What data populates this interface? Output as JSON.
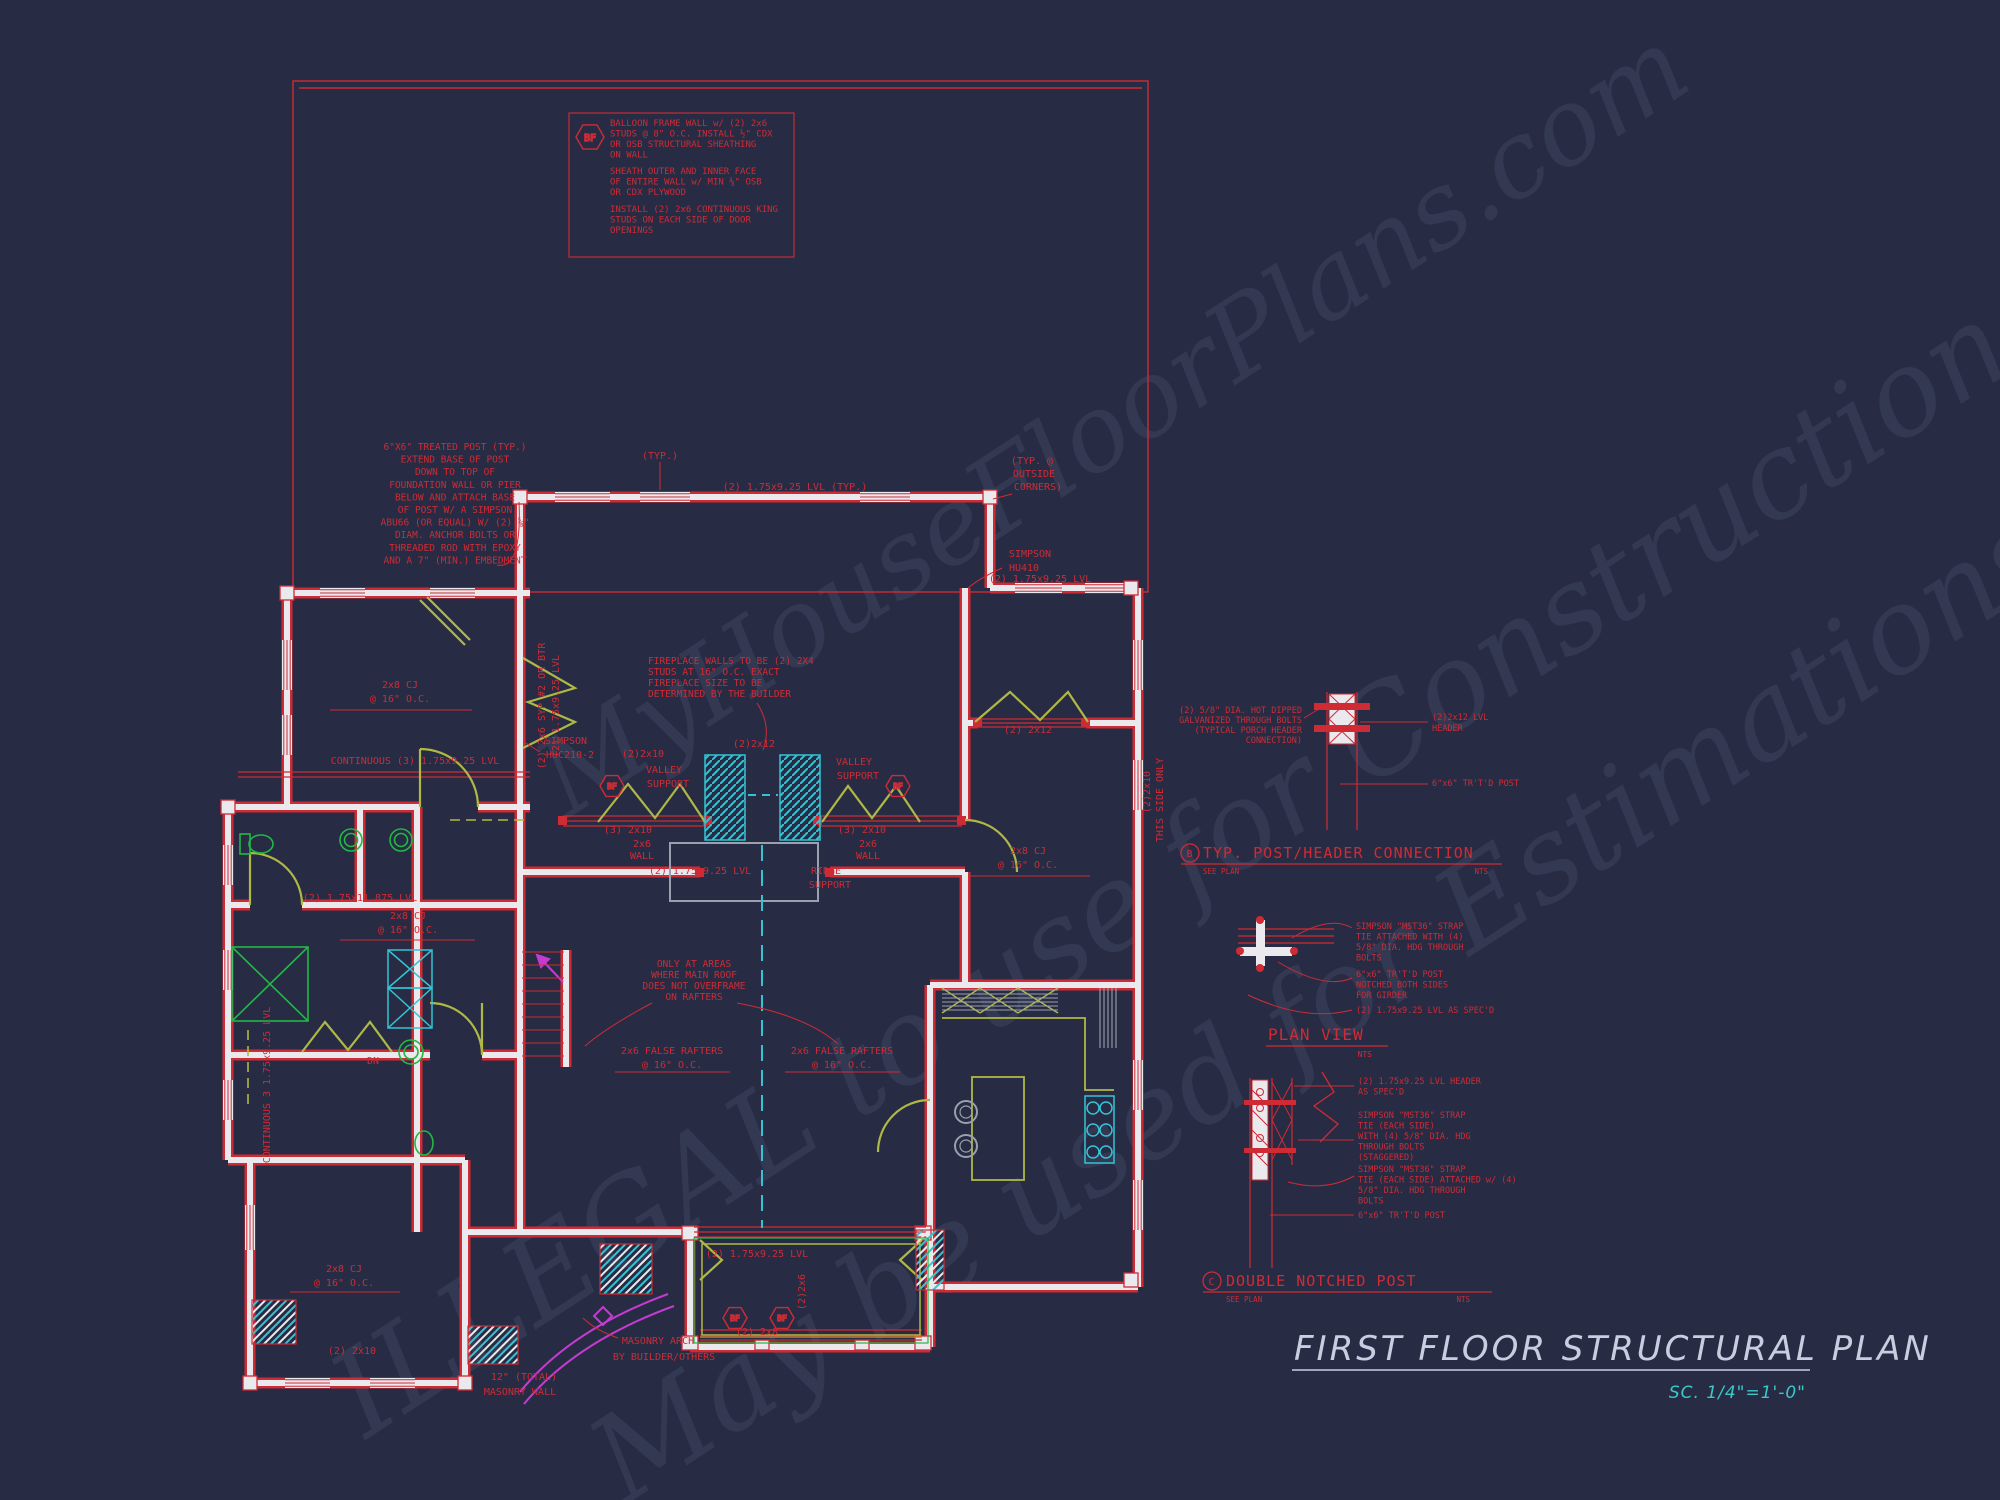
{
  "colors": {
    "background": "#272c44",
    "cad_red": "#cf2b35",
    "olive_header": "#b0b845",
    "cyan": "#35c3d4",
    "green_fixture": "#21b944",
    "magenta": "#c43bd0",
    "wall_white": "#e9e9ee",
    "gray_line": "#9aa0ad",
    "title_light": "#c9cde0",
    "scale_cyan": "#38caca",
    "orange": "#d08030"
  },
  "watermarks": [
    {
      "text": "MyHouseFloorPlans.com"
    },
    {
      "text": "ILLEGAL to use for Construction"
    },
    {
      "text": "May be used for Estimations"
    }
  ],
  "markers": {
    "bf": "BF"
  },
  "notes": [
    {
      "id": "bf1",
      "x": 610,
      "y": 126,
      "lh": 10.5,
      "size": 9,
      "anchor": "start",
      "lines": [
        "BALLOON FRAME WALL w/ (2) 2x6",
        "STUDS @ 8\" O.C. INSTALL ½\" CDX",
        "OR OSB STRUCTURAL SHEATHING",
        "ON WALL"
      ]
    },
    {
      "id": "bf2",
      "x": 610,
      "y": 174,
      "lh": 10.5,
      "size": 9,
      "anchor": "start",
      "lines": [
        "SHEATH OUTER AND INNER FACE",
        "OF ENTIRE WALL w/ MIN ⅜\" OSB",
        "OR CDX PLYWOOD"
      ]
    },
    {
      "id": "bf3",
      "x": 610,
      "y": 212,
      "lh": 10.5,
      "size": 9,
      "anchor": "start",
      "lines": [
        "INSTALL (2) 2x6 CONTINUOUS KING",
        "STUDS ON EACH SIDE OF DOOR",
        "OPENINGS"
      ]
    },
    {
      "id": "treated_post",
      "x": 455,
      "y": 450,
      "lh": 12.6,
      "size": 9.5,
      "anchor": "middle",
      "lines": [
        "6\"X6\" TREATED POST (TYP.)",
        "EXTEND BASE OF POST",
        "DOWN TO TOP OF",
        "FOUNDATION WALL OR PIER",
        "BELOW AND ATTACH BASE",
        "OF POST W/ A SIMPSON",
        "ABU66 (OR EQUAL) W/ (2) ⅝\"",
        "DIAM. ANCHOR BOLTS OR",
        "THREADED ROD WITH EPOXY",
        "AND A 7\" (MIN.) EMBEDMENT"
      ]
    },
    {
      "id": "fireplace",
      "x": 648,
      "y": 664,
      "lh": 11,
      "size": 9.5,
      "anchor": "start",
      "lines": [
        "FIREPLACE WALLS TO BE (2) 2X4",
        "STUDS AT 16\" O.C. EXACT",
        "FIREPLACE SIZE TO BE",
        "DETERMINED BY THE BUILDER"
      ]
    },
    {
      "id": "overframe",
      "x": 694,
      "y": 967,
      "lh": 11,
      "size": 9.5,
      "anchor": "middle",
      "lines": [
        "ONLY AT AREAS",
        "WHERE MAIN ROOF",
        "DOES NOT OVERFRAME",
        "ON RAFTERS"
      ]
    },
    {
      "id": "detail_b_left",
      "x": 1302,
      "y": 713,
      "lh": 10,
      "size": 8.5,
      "anchor": "end",
      "lines": [
        "(2) 5/8\" DIA. HOT DIPPED",
        "GALVANIZED THROUGH BOLTS",
        "(TYPICAL PORCH HEADER",
        "CONNECTION)"
      ]
    },
    {
      "id": "detail_b_right1",
      "x": 1432,
      "y": 720,
      "lh": 11,
      "size": 8.5,
      "anchor": "start",
      "lines": [
        "(2)2x12 LVL",
        "HEADER"
      ]
    },
    {
      "id": "detail_b_right2",
      "x": 1432,
      "y": 786,
      "lh": 11,
      "size": 8.5,
      "anchor": "start",
      "lines": [
        "6\"x6\" TR'T'D POST"
      ]
    },
    {
      "id": "plan_view_n1",
      "x": 1356,
      "y": 929,
      "lh": 10.5,
      "size": 8.5,
      "anchor": "start",
      "lines": [
        "SIMPSON \"MST36\" STRAP",
        "TIE ATTACHED WITH (4)",
        "5/8\" DIA. HDG THROUGH",
        "BOLTS"
      ]
    },
    {
      "id": "plan_view_n2",
      "x": 1356,
      "y": 977,
      "lh": 10.5,
      "size": 8.5,
      "anchor": "start",
      "lines": [
        "6\"x6\" TR'T'D POST",
        "NOTCHED BOTH SIDES",
        "FOR GIRDER"
      ]
    },
    {
      "id": "plan_view_n3",
      "x": 1356,
      "y": 1013,
      "lh": 10.5,
      "size": 8.5,
      "anchor": "start",
      "lines": [
        "(2) 1.75x9.25 LVL AS SPEC'D"
      ]
    },
    {
      "id": "detail_c_n1",
      "x": 1358,
      "y": 1084,
      "lh": 10.5,
      "size": 8.5,
      "anchor": "start",
      "lines": [
        "(2) 1.75x9.25 LVL HEADER",
        "AS SPEC'D"
      ]
    },
    {
      "id": "detail_c_n2",
      "x": 1358,
      "y": 1118,
      "lh": 10.5,
      "size": 8.5,
      "anchor": "start",
      "lines": [
        "SIMPSON \"MST36\" STRAP",
        "TIE (EACH SIDE)",
        "WITH (4) 5/8\" DIA. HDG",
        "THROUGH BOLTS",
        "(STAGGERED)"
      ]
    },
    {
      "id": "detail_c_n3",
      "x": 1358,
      "y": 1172,
      "lh": 10.5,
      "size": 8.5,
      "anchor": "start",
      "lines": [
        "SIMPSON \"MST36\" STRAP",
        "TIE (EACH SIDE) ATTACHED w/ (4)",
        "5/8\" DIA. HDG THROUGH",
        "BOLTS"
      ]
    },
    {
      "id": "detail_c_n4",
      "x": 1358,
      "y": 1218,
      "lh": 10.5,
      "size": 8.5,
      "anchor": "start",
      "lines": [
        "6\"x6\" TR'T'D POST"
      ]
    }
  ],
  "plan": {
    "labels": [
      {
        "t": "(TYP.)",
        "x": 660,
        "y": 459
      },
      {
        "t": "(2) 1.75x9.25 LVL (TYP.)",
        "x": 795,
        "y": 490
      },
      {
        "t": "(TYP. @",
        "x": 1032,
        "y": 464
      },
      {
        "t": "OUTSIDE",
        "x": 1034,
        "y": 477
      },
      {
        "t": "CORNERS)",
        "x": 1038,
        "y": 490
      },
      {
        "t": "SIMPSON",
        "x": 1030,
        "y": 557
      },
      {
        "t": "HU410",
        "x": 1024,
        "y": 571
      },
      {
        "t": "(2) 1.75x9.25 LVL",
        "x": 1040,
        "y": 582
      },
      {
        "t": "SIMPSON",
        "x": 566,
        "y": 744
      },
      {
        "t": "HUC210-2",
        "x": 570,
        "y": 758
      },
      {
        "t": "2x8 CJ",
        "x": 400,
        "y": 688
      },
      {
        "t": "@ 16\" O.C.",
        "x": 400,
        "y": 702
      },
      {
        "t": "CONTINUOUS (3) 1.75x9.25 LVL",
        "x": 415,
        "y": 764
      },
      {
        "t": "(2) 1.75x11.875 LVL",
        "x": 360,
        "y": 901
      },
      {
        "t": "2x8 CJ",
        "x": 408,
        "y": 919
      },
      {
        "t": "@ 16\" O.C.",
        "x": 408,
        "y": 933
      },
      {
        "t": "(2)2x10",
        "x": 643,
        "y": 757
      },
      {
        "t": "VALLEY",
        "x": 664,
        "y": 773
      },
      {
        "t": "SUPPORT",
        "x": 668,
        "y": 787
      },
      {
        "t": "VALLEY",
        "x": 854,
        "y": 765
      },
      {
        "t": "SUPPORT",
        "x": 858,
        "y": 779
      },
      {
        "t": "(3) 2x10",
        "x": 628,
        "y": 833
      },
      {
        "t": "(3) 2x10",
        "x": 862,
        "y": 833
      },
      {
        "t": "2x6",
        "x": 642,
        "y": 847
      },
      {
        "t": "WALL",
        "x": 642,
        "y": 859
      },
      {
        "t": "2x6",
        "x": 868,
        "y": 847
      },
      {
        "t": "WALL",
        "x": 868,
        "y": 859
      },
      {
        "t": "(2) 1.75x9.25 LVL",
        "x": 700,
        "y": 874
      },
      {
        "t": "RIDGE",
        "x": 826,
        "y": 874
      },
      {
        "t": "SUPPORT",
        "x": 830,
        "y": 888
      },
      {
        "t": "(2)2x12",
        "x": 754,
        "y": 747
      },
      {
        "t": "2x8 CJ",
        "x": 1028,
        "y": 854
      },
      {
        "t": "@ 16\" O.C.",
        "x": 1028,
        "y": 868
      },
      {
        "t": "(2) 2x12",
        "x": 1028,
        "y": 733
      },
      {
        "t": "(2)2x10",
        "x": 1150,
        "y": 792,
        "r": -90
      },
      {
        "t": "THIS SIDE ONLY",
        "x": 1163,
        "y": 800,
        "r": -90
      },
      {
        "t": "2x6 FALSE RAFTERS",
        "x": 672,
        "y": 1054
      },
      {
        "t": "@ 16\" O.C.",
        "x": 672,
        "y": 1068
      },
      {
        "t": "2x6 FALSE RAFTERS",
        "x": 842,
        "y": 1054
      },
      {
        "t": "@ 16\" O.C.",
        "x": 842,
        "y": 1068
      },
      {
        "t": "(2) 1.75x9.25 LVL",
        "x": 757,
        "y": 1257
      },
      {
        "t": "(2) 2x8",
        "x": 757,
        "y": 1335
      },
      {
        "t": "MASONRY ARCH",
        "x": 658,
        "y": 1344
      },
      {
        "t": "BY BUILDER/OTHERS",
        "x": 664,
        "y": 1360
      },
      {
        "t": "12\" (TOTAL)",
        "x": 524,
        "y": 1380
      },
      {
        "t": "MASONRY WALL",
        "x": 520,
        "y": 1395
      },
      {
        "t": "2x8 CJ",
        "x": 344,
        "y": 1272
      },
      {
        "t": "@ 16\" O.C.",
        "x": 344,
        "y": 1286
      },
      {
        "t": "(2) 2x10",
        "x": 352,
        "y": 1354
      },
      {
        "t": "CONTINUOUS 3 1.75x9.25 LVL",
        "x": 270,
        "y": 1085,
        "r": -90
      },
      {
        "t": "(2) 2x6 SYP #2 OR BTR",
        "x": 545,
        "y": 706,
        "r": -90
      },
      {
        "t": "(2) 1.75x9.25 LVL",
        "x": 559,
        "y": 706,
        "r": -90
      },
      {
        "t": "DN",
        "x": 373,
        "y": 1064
      },
      {
        "t": "(2)2x6",
        "x": 805,
        "y": 1292,
        "r": -90
      }
    ]
  },
  "details": {
    "b": {
      "symbol": "B",
      "title": "TYP. POST/HEADER CONNECTION",
      "see": "SEE PLAN",
      "nts": "NTS"
    },
    "plan_view": {
      "title": "PLAN VIEW",
      "nts": "NTS"
    },
    "c": {
      "symbol": "C",
      "title": "DOUBLE NOTCHED POST",
      "see": "SEE PLAN",
      "nts": "NTS"
    }
  },
  "title_block": {
    "title": "FIRST FLOOR STRUCTURAL PLAN",
    "scale": "SC. 1/4\"=1'-0\""
  }
}
